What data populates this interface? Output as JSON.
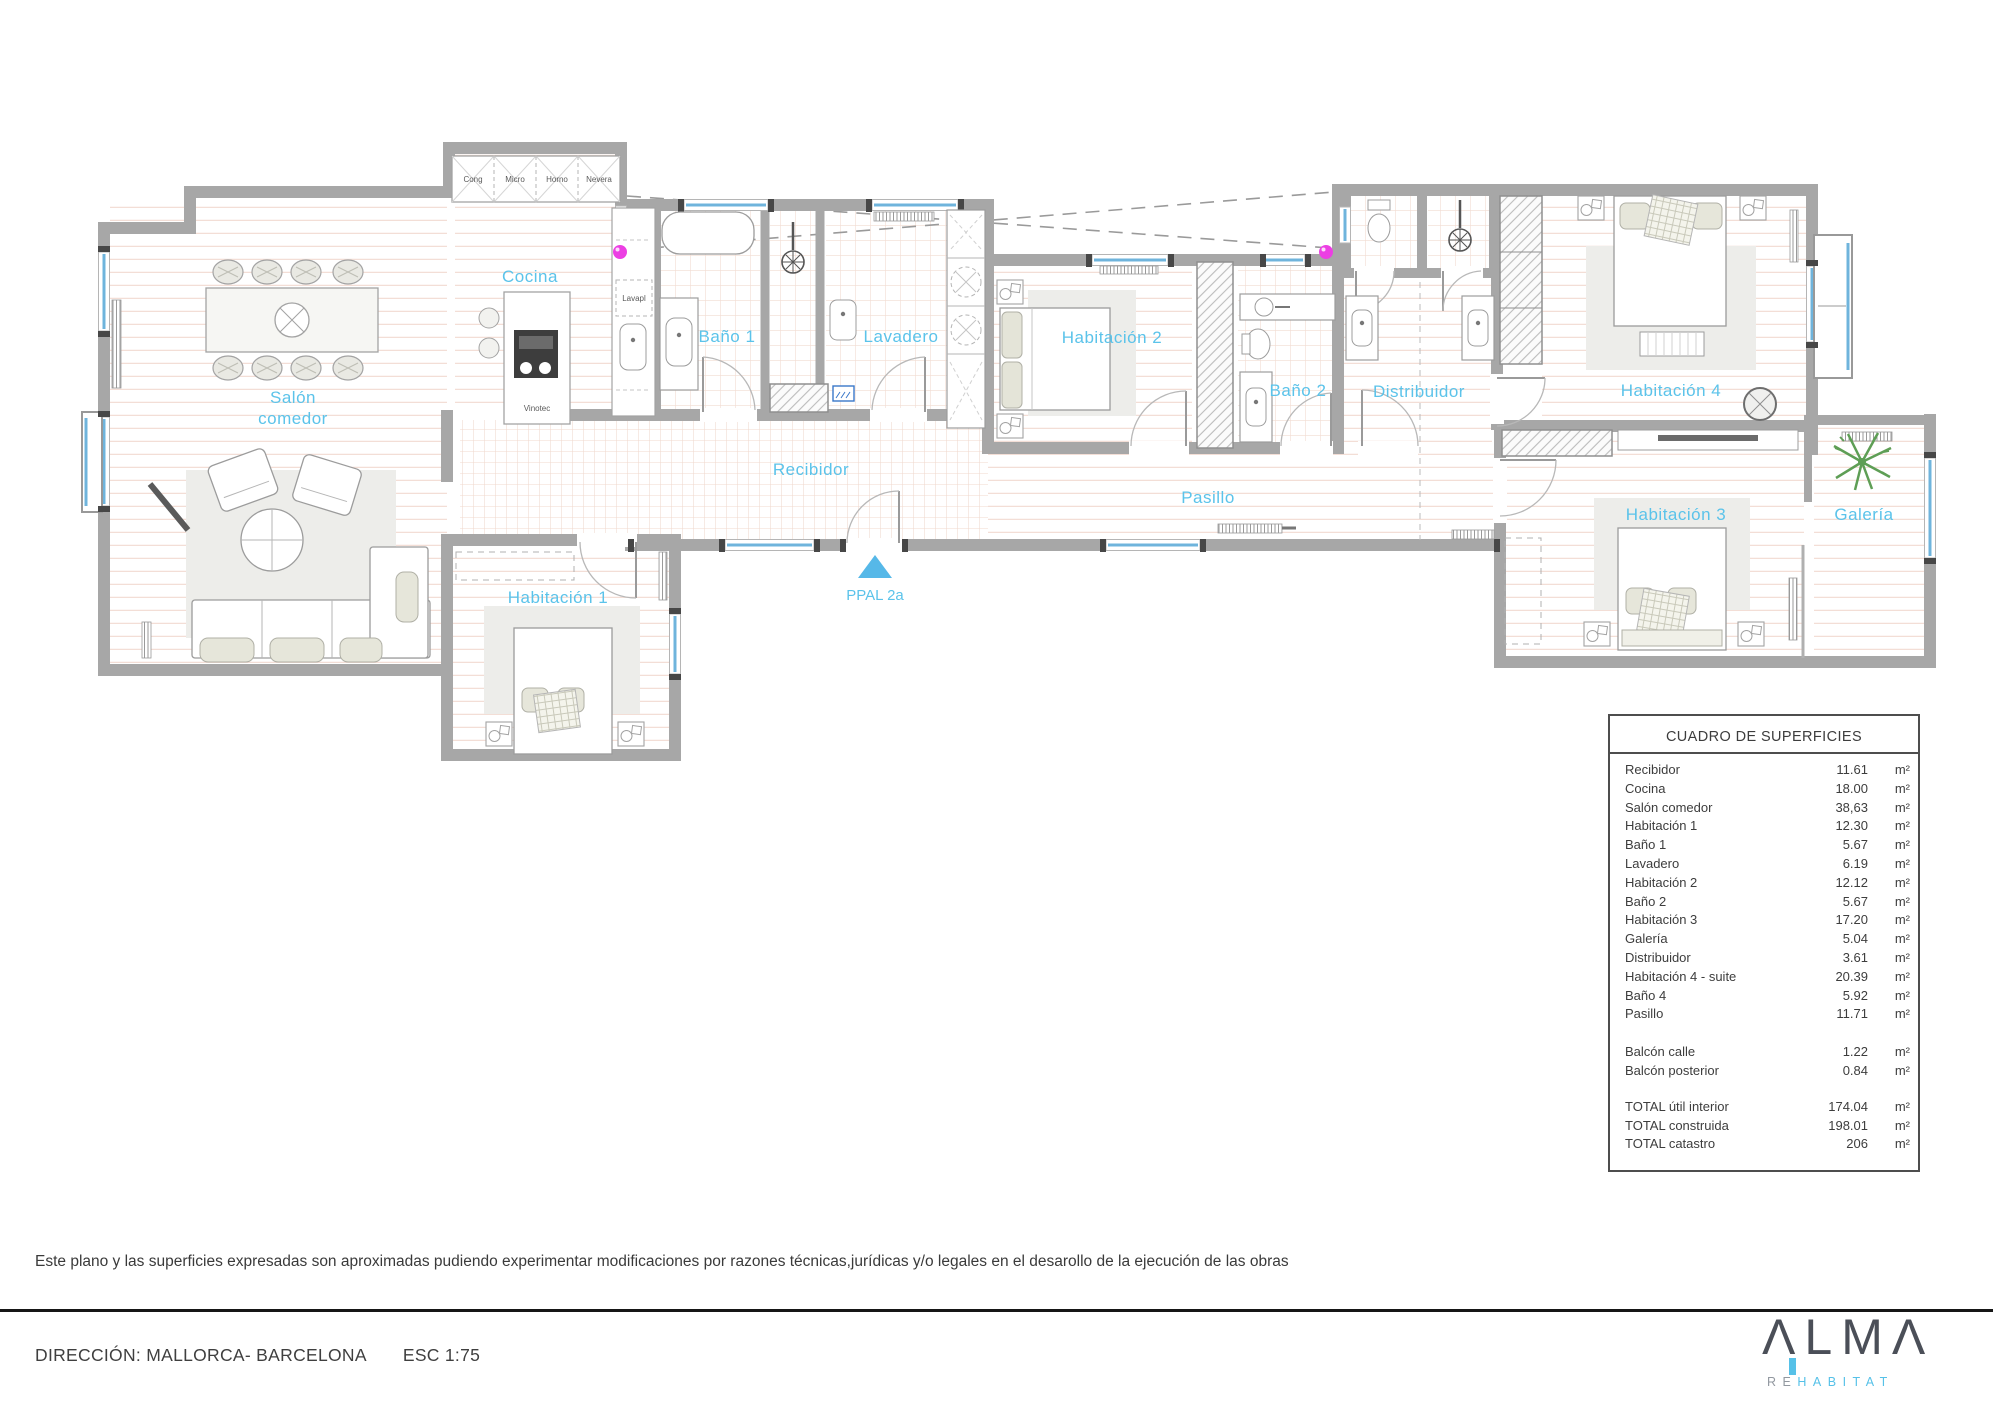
{
  "plan": {
    "labels": {
      "salon1": "Salón",
      "salon2": "comedor",
      "cocina": "Cocina",
      "bano1": "Baño 1",
      "lavadero": "Lavadero",
      "habitacion2": "Habitación 2",
      "bano2": "Baño 2",
      "distribuidor": "Distribuidor",
      "habitacion4": "Habitación 4",
      "habitacion3": "Habitación 3",
      "galeria": "Galería",
      "recibidor": "Recibidor",
      "pasillo": "Pasillo",
      "habitacion1": "Habitación 1",
      "entrada": "PPAL 2a"
    },
    "appliances": {
      "cong": "Cong",
      "micro": "Micro",
      "horno": "Horno",
      "nevera": "Nevera",
      "lavapl": "Lavapl",
      "vinotec": "Vinotec"
    }
  },
  "surface_table": {
    "title": "CUADRO DE SUPERFICIES",
    "unit": "m²",
    "rows": [
      {
        "label": "Recibidor",
        "value": "11.61"
      },
      {
        "label": "Cocina",
        "value": "18.00"
      },
      {
        "label": "Salón comedor",
        "value": "38,63"
      },
      {
        "label": "Habitación 1",
        "value": "12.30"
      },
      {
        "label": "Baño 1",
        "value": "5.67"
      },
      {
        "label": "Lavadero",
        "value": "6.19"
      },
      {
        "label": "Habitación 2",
        "value": "12.12"
      },
      {
        "label": "Baño 2",
        "value": "5.67"
      },
      {
        "label": "Habitación 3",
        "value": "17.20"
      },
      {
        "label": "Galería",
        "value": "5.04"
      },
      {
        "label": "Distribuidor",
        "value": "3.61"
      },
      {
        "label": "Habitación 4 - suite",
        "value": "20.39"
      },
      {
        "label": "Baño 4",
        "value": "5.92"
      },
      {
        "label": "Pasillo",
        "value": "11.71"
      }
    ],
    "balcony_rows": [
      {
        "label": "Balcón calle",
        "value": "1.22"
      },
      {
        "label": "Balcón posterior",
        "value": "0.84"
      }
    ],
    "total_rows": [
      {
        "label": "TOTAL útil interior",
        "value": "174.04"
      },
      {
        "label": "TOTAL construida",
        "value": "198.01"
      },
      {
        "label": "TOTAL catastro",
        "value": "206"
      }
    ]
  },
  "footer": {
    "disclaimer": "Este plano y las superficies expresadas son aproximadas pudiendo experimentar modificaciones por razones técnicas,jurídicas y/o legales en el desarollo de la ejecución de las obras",
    "direccion": "DIRECCIÓN: MALLORCA- BARCELONA",
    "escala": "ESC 1:75"
  },
  "logo": {
    "wordmark": "ΛLMΛ",
    "sub_re": "RE",
    "sub_habitat": "HABITAT"
  },
  "colors": {
    "label_blue": "#5bc3ea",
    "wall_gray": "#a7a7a7",
    "window_blue": "#6fb4dc",
    "floor_line": "#f3ded6",
    "magenta_marker": "#ec3fe3",
    "plant_green": "#5e9e55",
    "logo_dark": "#4b4f58",
    "logo_blue": "#56c1e8"
  }
}
